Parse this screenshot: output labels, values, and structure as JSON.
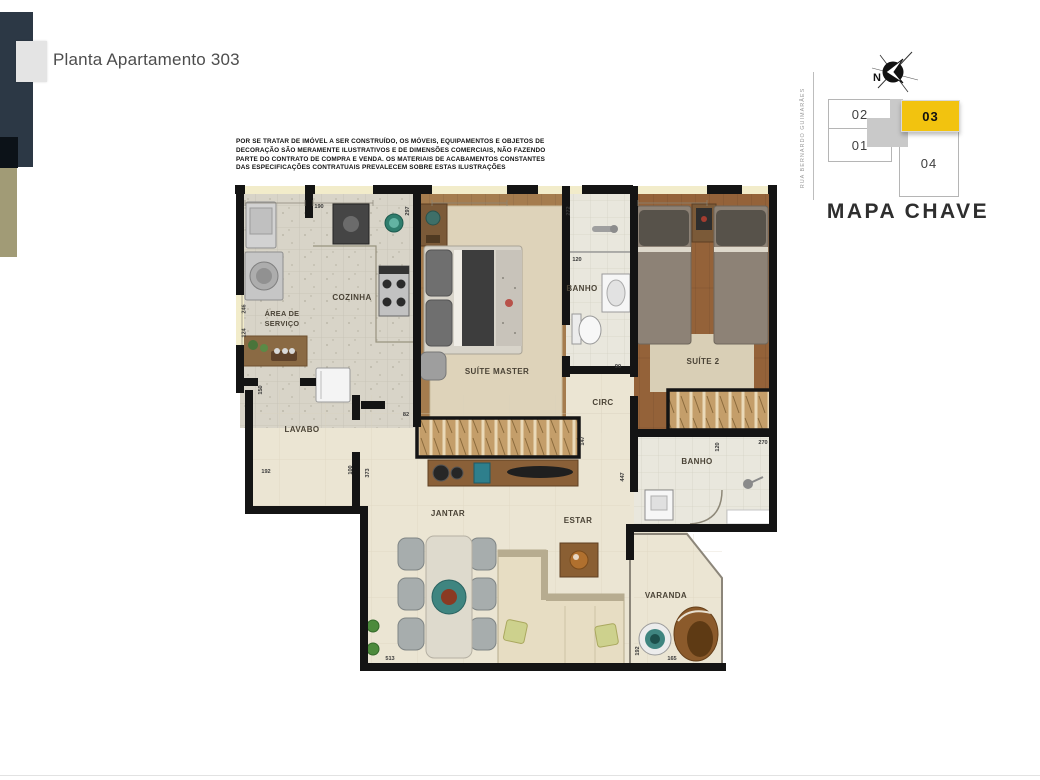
{
  "header": {
    "title": "Planta Apartamento 303"
  },
  "disclaimer": {
    "lines": [
      "POR SE TRATAR DE IMÓVEL A SER CONSTRUÍDO, OS MÓVEIS, EQUIPAMENTOS E OBJETOS DE",
      "DECORAÇÃO SÃO MERAMENTE ILUSTRATIVOS E DE DIMENSÕES COMERCIAIS, NÃO FAZENDO",
      "PARTE DO CONTRATO DE COMPRA E VENDA. OS MATERIAIS DE ACABAMENTOS CONSTANTES",
      "DAS ESPECIFICAÇÕES CONTRATUAIS PREVALECEM SOBRE ESTAS ILUSTRAÇÕES"
    ]
  },
  "key_map": {
    "title": "MAPA CHAVE",
    "street": "RUA BERNARDO GUIMARÃES",
    "north_label": "N",
    "highlight_color": "#F2C30F",
    "units": [
      {
        "id": "02",
        "highlighted": false
      },
      {
        "id": "01",
        "highlighted": false
      },
      {
        "id": "03",
        "highlighted": true
      },
      {
        "id": "04",
        "highlighted": false
      }
    ]
  },
  "floor_plan": {
    "rooms": [
      {
        "label": "ÁREA DE",
        "label2": "SERVIÇO"
      },
      {
        "label": "COZINHA"
      },
      {
        "label": "SUÍTE MASTER"
      },
      {
        "label": "BANHO"
      },
      {
        "label": "SUÍTE 2"
      },
      {
        "label": "CIRC"
      },
      {
        "label": "BANHO"
      },
      {
        "label": "LAVABO"
      },
      {
        "label": "JANTAR"
      },
      {
        "label": "ESTAR"
      },
      {
        "label": "VARANDA"
      }
    ],
    "dimensions": [
      "190",
      "297",
      "272",
      "120",
      "90",
      "82",
      "147",
      "447",
      "120",
      "270",
      "150",
      "192",
      "100",
      "373",
      "246",
      "124",
      "513",
      "192",
      "165"
    ]
  },
  "colors": {
    "accent_yellow": "#F2C30F",
    "bar_navy": "#2C3845",
    "bar_olive": "#A19B76",
    "bar_black": "#0C1218"
  }
}
